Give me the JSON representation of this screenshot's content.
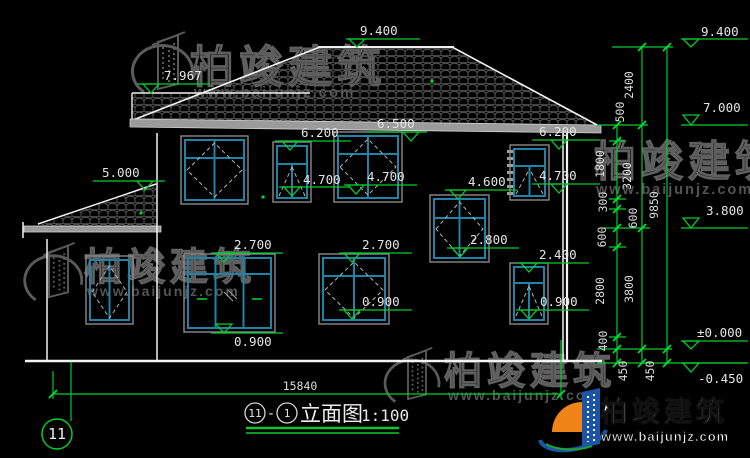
{
  "drawing": {
    "name": "立面图",
    "scale": "1:100",
    "sheet_axis": "11",
    "ref_a": "11",
    "ref_b": "1",
    "separator": "-"
  },
  "levels": {
    "ridge": "9.400",
    "left_wing_roof": "7.967",
    "porch_roof": "5.000",
    "eaves": "6.500",
    "f2_window_top": "6.200",
    "f2_window_sill": "4.700",
    "stair_window_top": "4.600",
    "stair_window_sill": "2.800",
    "f1_window_top": "2.700",
    "f1_small_window_top": "2.400",
    "f1_window_sill": "0.900",
    "right_eaves": "7.000",
    "second_floor": "3.800",
    "ground_zero": "±0.000",
    "site_level": "-0.450"
  },
  "chains": {
    "fine": [
      "500",
      "1800",
      "300",
      "600",
      "600",
      "2800",
      "400",
      "450"
    ],
    "floors": [
      "2400",
      "3200",
      "3800",
      "450"
    ],
    "total_height": "9850",
    "total_width": "15840"
  },
  "watermark": {
    "brand": "柏竣建筑",
    "site": "www.baijunjz.com"
  }
}
